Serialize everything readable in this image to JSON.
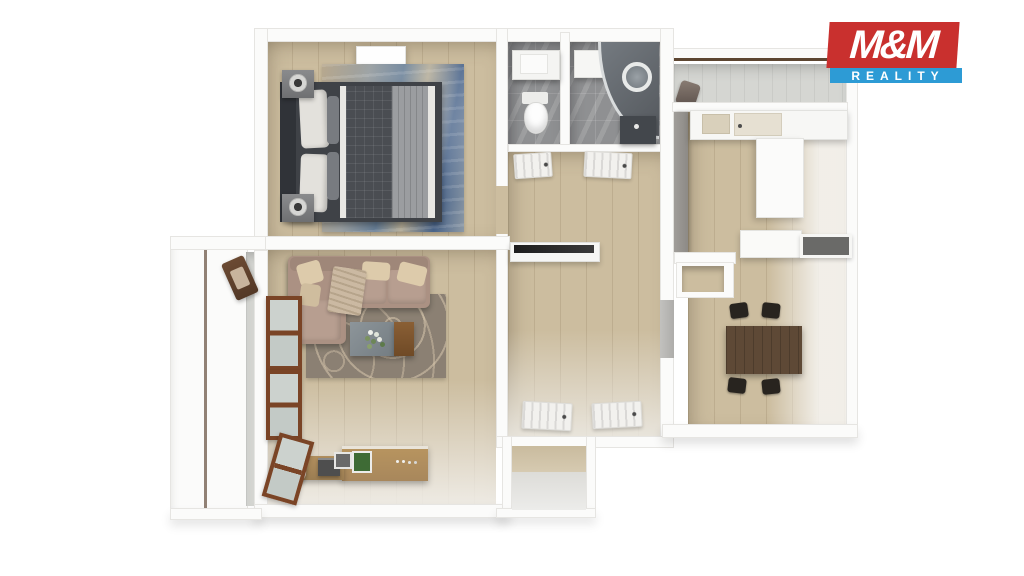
{
  "title": "3D apartment floor plan rendering",
  "logo": {
    "line1": "M&M",
    "line2": "REALITY"
  },
  "palette": {
    "bg": "#ffffff",
    "wall": "#fbfbfa",
    "wall-edge": "#e6e5e2",
    "wood": "#ccbd9f",
    "tile-gray": "#8f9092",
    "balcony-floor": "#d5d6d2",
    "partition-gray": "#a09d99",
    "bed-dark": "#3f4247",
    "headboard-dark": "#303338",
    "blanket-gray": "#9b9da0",
    "rug-blue": "#667d95",
    "rug-sand": "#b7a88e",
    "sofa": "#ab9183",
    "cushion": "#b79e90",
    "pillow-cream": "#ddcbab",
    "rug-living": "#8b8073",
    "rug-pattern": "#d8c7ad",
    "wood-furniture": "#a8875c",
    "window-frame": "#7a4426",
    "table-dark": "#5e4936",
    "chair-black": "#28241f",
    "shower-dark": "#54585d",
    "vanity-dark": "#43474c",
    "logo-red": "#c9302e",
    "logo-blue": "#2d9bd5",
    "logo-text": "#ffffff",
    "lamp-core": "#3a3a3a"
  },
  "scene": {
    "view": "top-down 3d dollhouse render",
    "rooms": [
      {
        "name": "bedroom",
        "position": "top-left",
        "furniture": [
          "double-bed",
          "headboard",
          "nightstand-x2",
          "table-lamp-x2",
          "blue-abstract-rug",
          "ceiling-light-panel"
        ]
      },
      {
        "name": "wc",
        "position": "top-center-left",
        "furniture": [
          "toilet",
          "cistern-shelf"
        ]
      },
      {
        "name": "bathroom",
        "position": "top-center",
        "furniture": [
          "corner-shower",
          "round-mirror",
          "dark-vanity",
          "light-panel"
        ]
      },
      {
        "name": "hallway",
        "position": "center",
        "furniture": [
          "wall-niche-shelf",
          "louvered-door-x4"
        ]
      },
      {
        "name": "kitchen",
        "position": "top-right",
        "furniture": [
          "counter-with-sink-and-hob",
          "tall-cabinet",
          "island-counter",
          "pass-through-niche",
          "gray-partition",
          "storage-nook"
        ]
      },
      {
        "name": "dining-room",
        "position": "right",
        "furniture": [
          "dark-wood-table",
          "black-chair-x4"
        ]
      },
      {
        "name": "living-room",
        "position": "bottom-left",
        "furniture": [
          "l-shaped-taupe-sofa",
          "cream-pillow-x4",
          "fringed-throw",
          "patterned-area-rug",
          "coffee-table-with-flowers",
          "wood-sideboard",
          "wood-low-cabinet",
          "cylinder-lamp",
          "wooden-window-x3"
        ]
      },
      {
        "name": "left-balcony",
        "position": "left",
        "furniture": [
          "folding-chair"
        ]
      },
      {
        "name": "top-balcony",
        "position": "top-right",
        "furniture": [
          "bag"
        ]
      },
      {
        "name": "entry-vestibule",
        "position": "bottom-center",
        "furniture": []
      }
    ]
  }
}
